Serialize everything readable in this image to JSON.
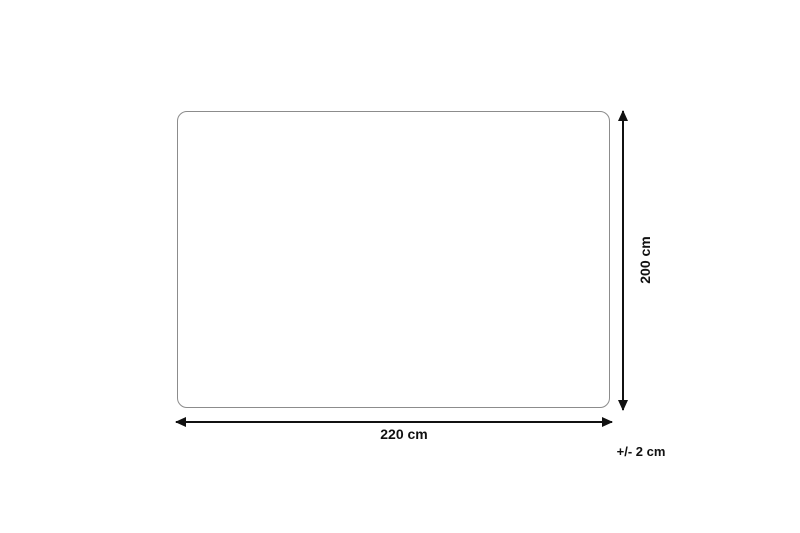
{
  "diagram": {
    "width_label": "220 cm",
    "height_label": "200 cm",
    "tolerance_label": "+/- 2 cm"
  },
  "icons": {
    "width_arrow": "double-headed-horizontal-arrow",
    "height_arrow": "double-headed-vertical-arrow"
  },
  "colors": {
    "background": "#ffffff",
    "outline": "#8c8c8c",
    "arrow": "#111111",
    "text": "#111111"
  }
}
